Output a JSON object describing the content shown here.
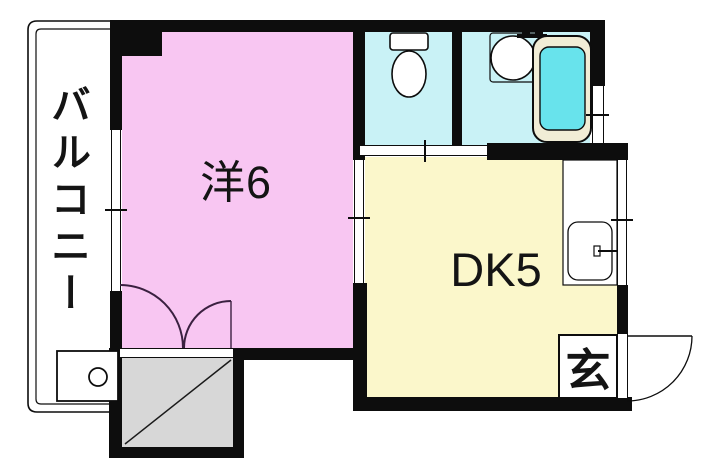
{
  "plan": {
    "type": "apartment-floor-plan",
    "rooms": {
      "balcony": {
        "label": "バルコニー"
      },
      "western_room": {
        "label": "洋6",
        "floor_color": "#F8C6F2"
      },
      "dining_kitchen": {
        "label": "DK5",
        "floor_color": "#FBF7CB"
      },
      "entrance": {
        "label": "玄"
      },
      "toilet": {
        "floor_color": "#C9F2F6"
      },
      "bathroom": {
        "floor_color": "#C9F2F6",
        "tub_fill_color": "#68E3EC",
        "tub_rim_color": "#F1EDD6"
      },
      "closet": {
        "floor_color": "#D7D7D7"
      }
    },
    "colors": {
      "wall": "#0d0d0d",
      "background": "#FFFFFF",
      "swing_door_arc": "#3A2040"
    }
  }
}
